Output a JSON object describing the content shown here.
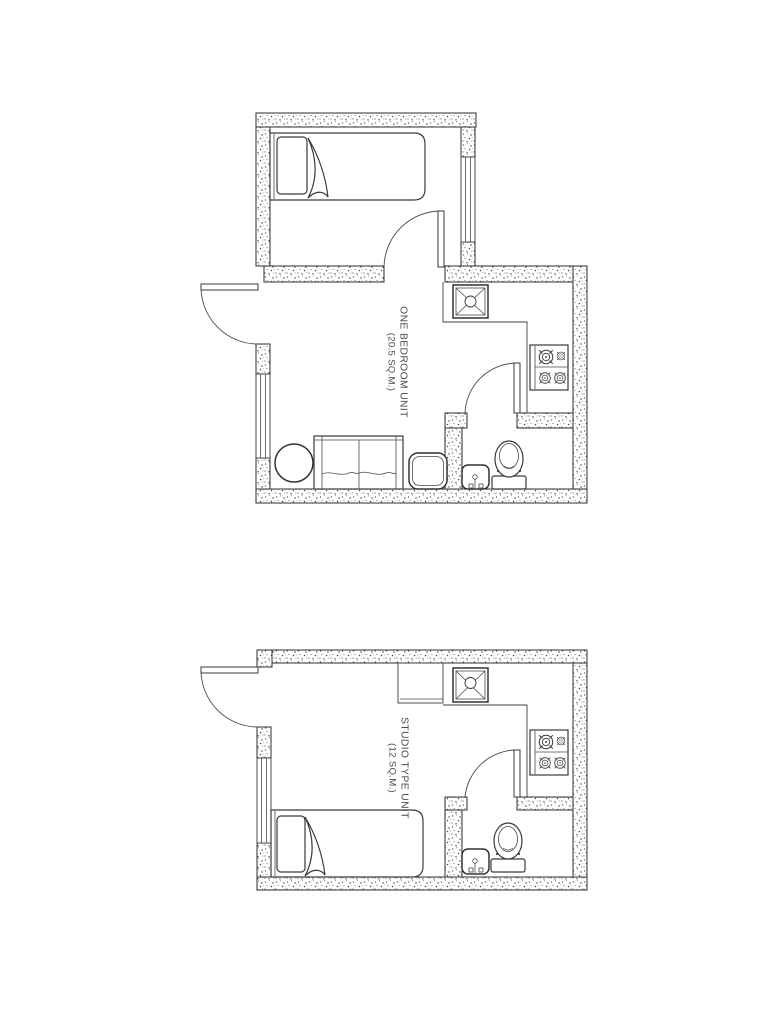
{
  "page": {
    "background": "#ffffff"
  },
  "drawing": {
    "line_color": "#3a3a3a",
    "text_color": "#4a4a4a",
    "wall_texture": "stipple"
  },
  "plans": [
    {
      "name": "one-bedroom-unit",
      "title": "ONE BEDROOM UNIT",
      "area": "(20.5 SQ.M.)"
    },
    {
      "name": "studio-type-unit",
      "title": "STUDIO TYPE UNIT",
      "area": "(12 SQ.M.)"
    }
  ]
}
